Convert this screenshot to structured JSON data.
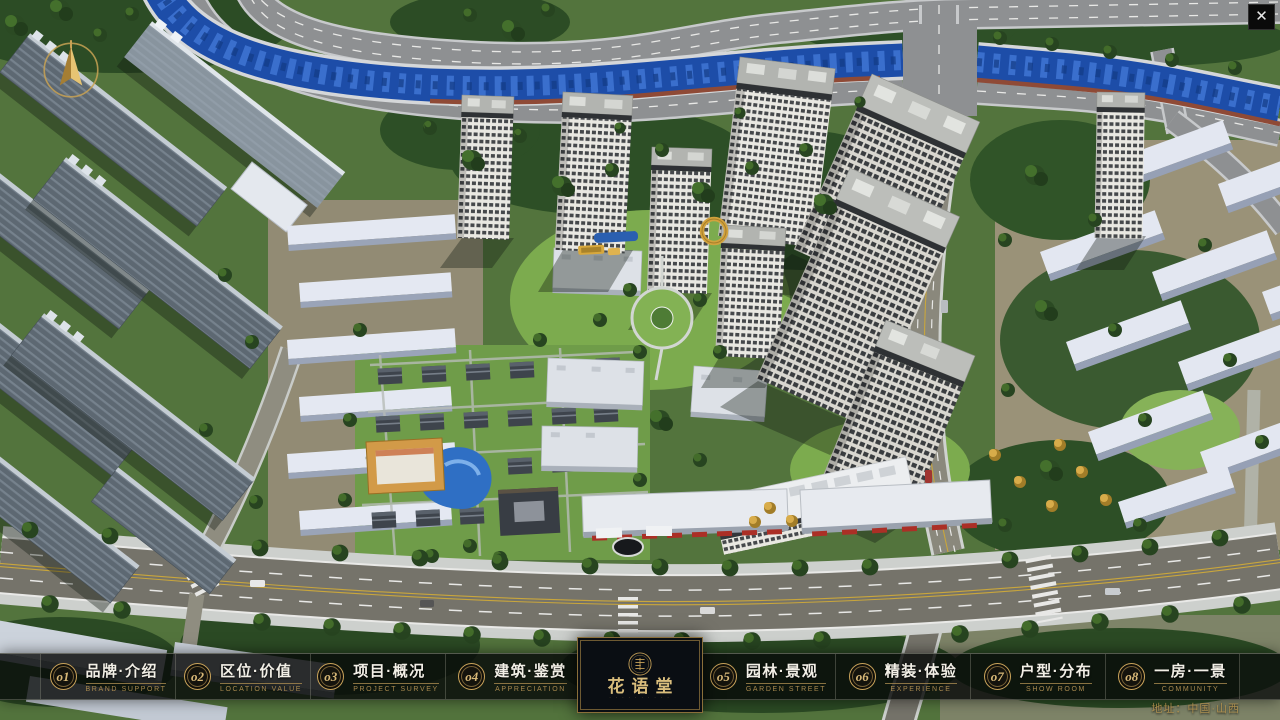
{
  "chrome": {
    "close_glyph": "✕"
  },
  "nav": {
    "items": [
      {
        "num": "o1",
        "zh": "品牌·介绍",
        "en": "BRAND SUPPORT"
      },
      {
        "num": "o2",
        "zh": "区位·价值",
        "en": "LOCATION VALUE"
      },
      {
        "num": "o3",
        "zh": "项目·概况",
        "en": "PROJECT SURVEY"
      },
      {
        "num": "o4",
        "zh": "建筑·鉴赏",
        "en": "APPRECIATION"
      },
      {
        "num": "o5",
        "zh": "园林·景观",
        "en": "GARDEN STREET"
      },
      {
        "num": "o6",
        "zh": "精装·体验",
        "en": "EXPERIENCE"
      },
      {
        "num": "o7",
        "zh": "户型·分布",
        "en": "SHOW ROOM"
      },
      {
        "num": "o8",
        "zh": "一房·一景",
        "en": "COMMUNITY"
      }
    ]
  },
  "logo": {
    "title": "花语堂",
    "tagline": "· · · · · · · · · ·"
  },
  "footer": {
    "address": "地址：中国·山西"
  },
  "colors": {
    "gold": "#c9a35a",
    "gold_dark": "#8a6f3a",
    "bar_background": "rgba(10,13,11,0.8)",
    "river_blue": "#1d4da8",
    "text_light": "#f2efe6"
  }
}
